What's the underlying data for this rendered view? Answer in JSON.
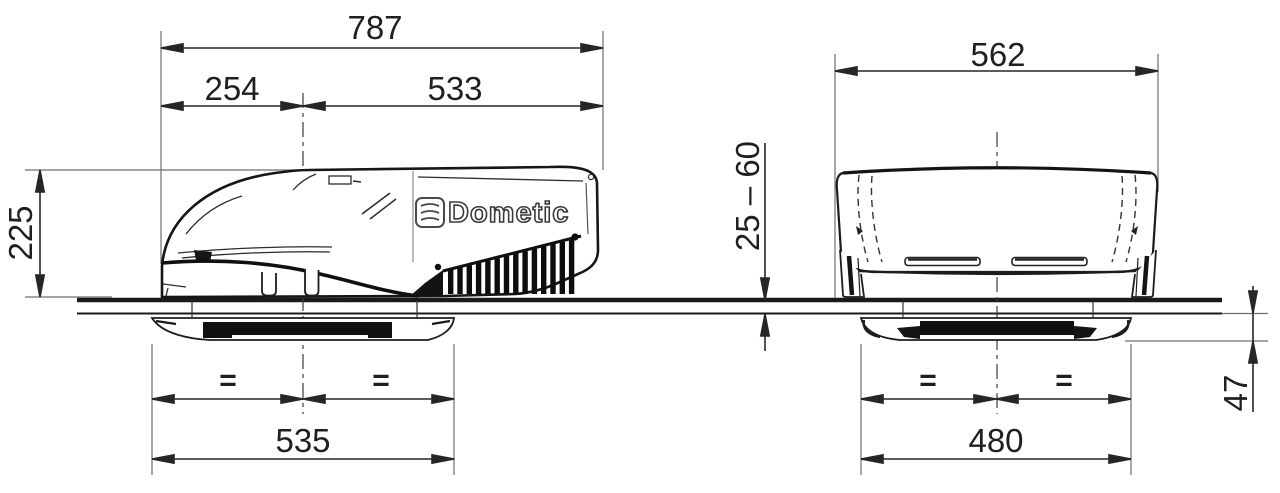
{
  "brand": {
    "name": "Dometic"
  },
  "side_view": {
    "total_length": "787",
    "front_section": "254",
    "rear_section": "533",
    "height": "225",
    "cutout_width": "535",
    "equal_left": "=",
    "equal_right": "="
  },
  "front_view": {
    "total_width": "562",
    "roof_thickness_range": "25 – 60",
    "cutout_width": "480",
    "interior_height": "47",
    "equal_left": "=",
    "equal_right": "="
  },
  "colors": {
    "ink": "#1f1f1f",
    "construction": "#6f6f6f",
    "background": "#ffffff"
  }
}
